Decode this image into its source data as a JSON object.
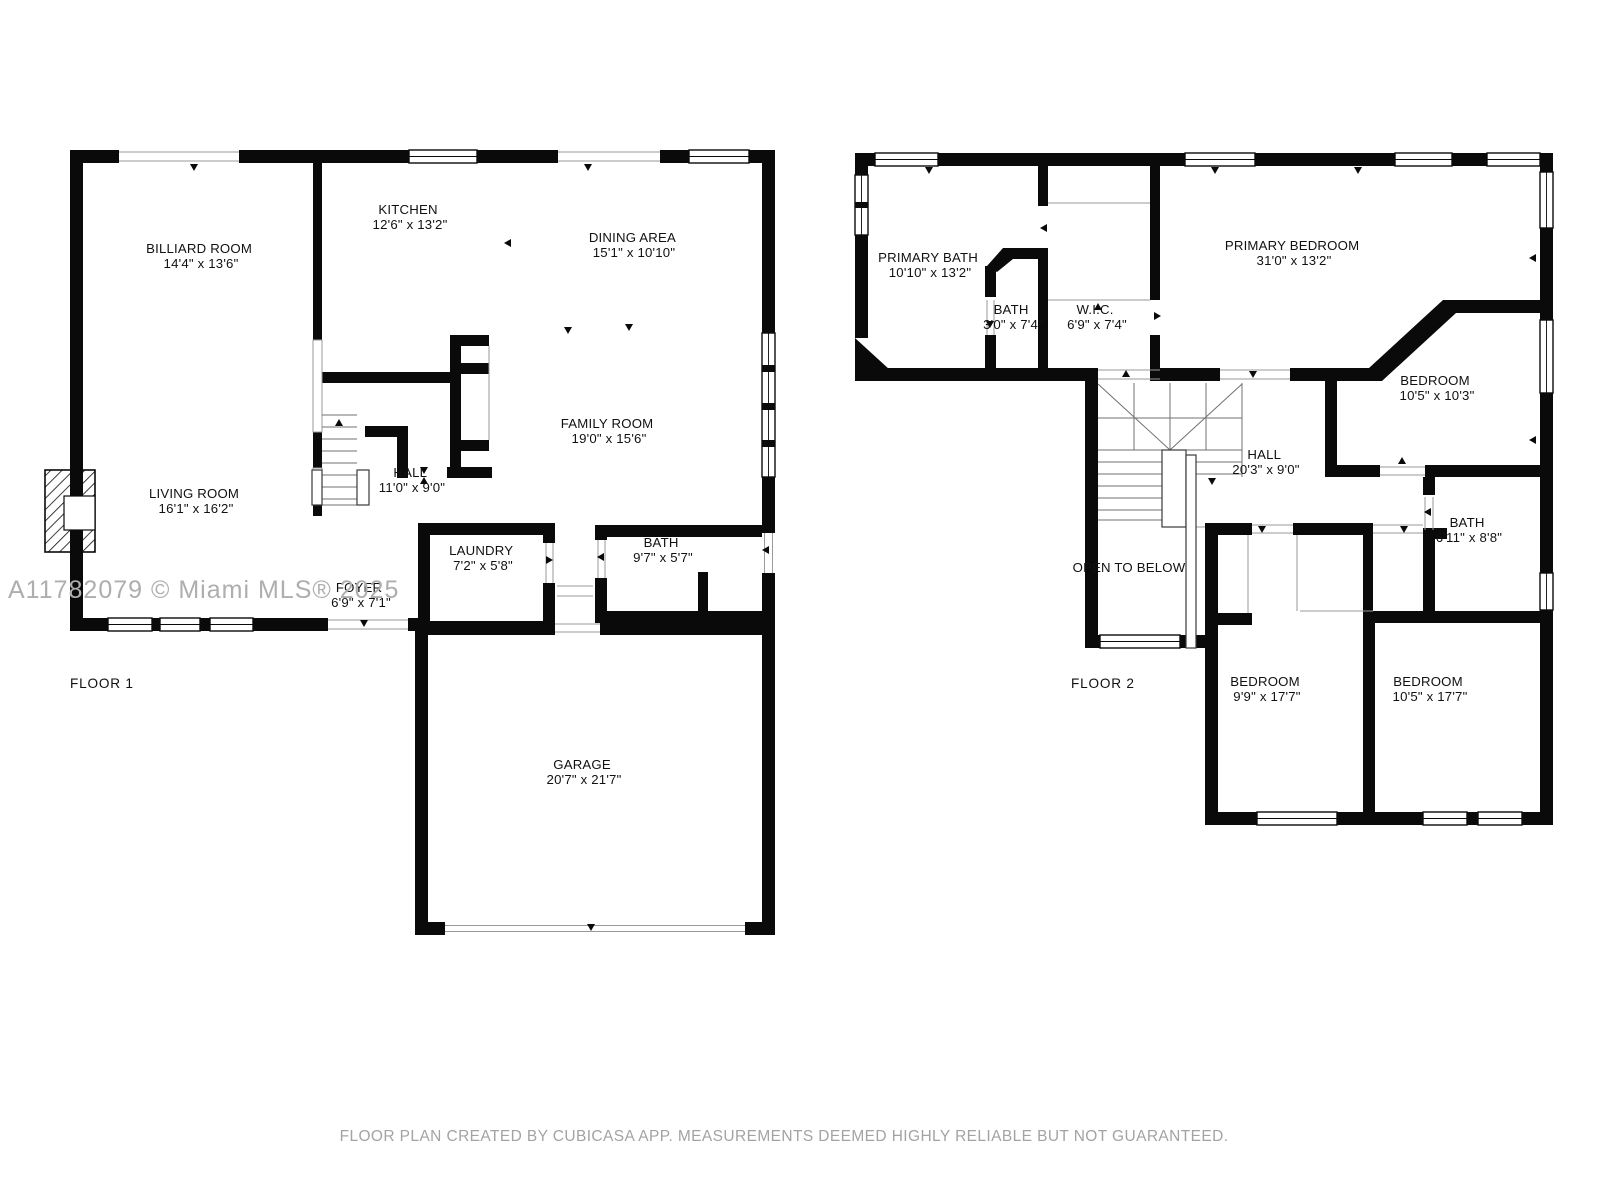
{
  "watermark": "A11782079 © Miami MLS® 2025",
  "disclaimer": "FLOOR PLAN CREATED BY CUBICASA APP. MEASUREMENTS DEEMED HIGHLY RELIABLE BUT NOT GUARANTEED.",
  "colors": {
    "walls": "#0A0A0A",
    "labels": "#111111",
    "watermark": "#AEAEAE",
    "disclaimer": "#A3A3A3",
    "background": "#FFFFFF"
  },
  "floors": [
    {
      "label": "FLOOR 1",
      "rooms": [
        {
          "name": "BILLIARD ROOM",
          "dims": "14'4\" x 13'6\""
        },
        {
          "name": "KITCHEN",
          "dims": "12'6\" x 13'2\""
        },
        {
          "name": "DINING AREA",
          "dims": "15'1\" x 10'10\""
        },
        {
          "name": "FAMILY ROOM",
          "dims": "19'0\" x 15'6\""
        },
        {
          "name": "HALL",
          "dims": "11'0\" x 9'0\""
        },
        {
          "name": "LIVING ROOM",
          "dims": "16'1\" x 16'2\""
        },
        {
          "name": "FOYER",
          "dims": "6'9\" x 7'1\""
        },
        {
          "name": "LAUNDRY",
          "dims": "7'2\" x 5'8\""
        },
        {
          "name": "BATH",
          "dims": "9'7\" x 5'7\""
        },
        {
          "name": "GARAGE",
          "dims": "20'7\" x 21'7\""
        }
      ]
    },
    {
      "label": "FLOOR 2",
      "rooms": [
        {
          "name": "PRIMARY BATH",
          "dims": "10'10\" x 13'2\""
        },
        {
          "name": "BATH",
          "dims": "3'0\" x 7'4\""
        },
        {
          "name": "W.I.C.",
          "dims": "6'9\" x 7'4\""
        },
        {
          "name": "PRIMARY BEDROOM",
          "dims": "31'0\" x 13'2\""
        },
        {
          "name": "BEDROOM",
          "dims": "10'5\" x 10'3\""
        },
        {
          "name": "HALL",
          "dims": "20'3\" x 9'0\""
        },
        {
          "name": "BATH",
          "dims": "6'11\" x 8'8\""
        },
        {
          "name": "OPEN TO BELOW",
          "dims": ""
        },
        {
          "name": "BEDROOM",
          "dims": "9'9\" x 17'7\""
        },
        {
          "name": "BEDROOM",
          "dims": "10'5\" x 17'7\""
        }
      ]
    }
  ]
}
